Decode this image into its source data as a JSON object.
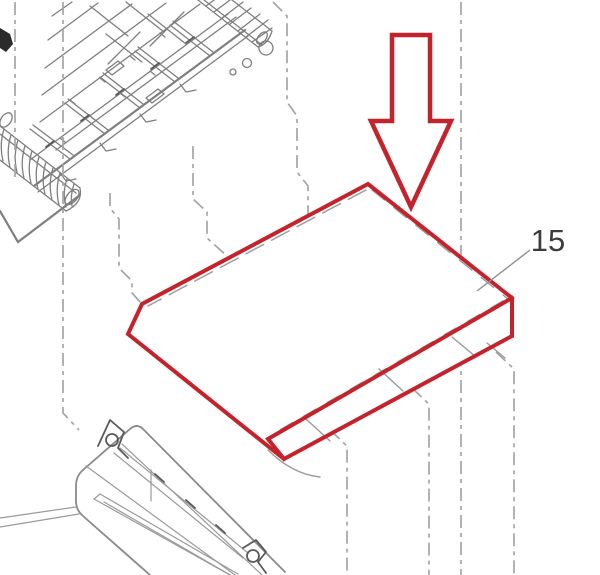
{
  "diagram": {
    "type": "exploded-parts-diagram",
    "callout": {
      "part_number": "15"
    },
    "colors": {
      "highlight": "#c5232b",
      "artwork": "#7f7f7f",
      "guide": "#a5a5a5",
      "label": "#3b3b3b",
      "background": "#ffffff"
    }
  }
}
